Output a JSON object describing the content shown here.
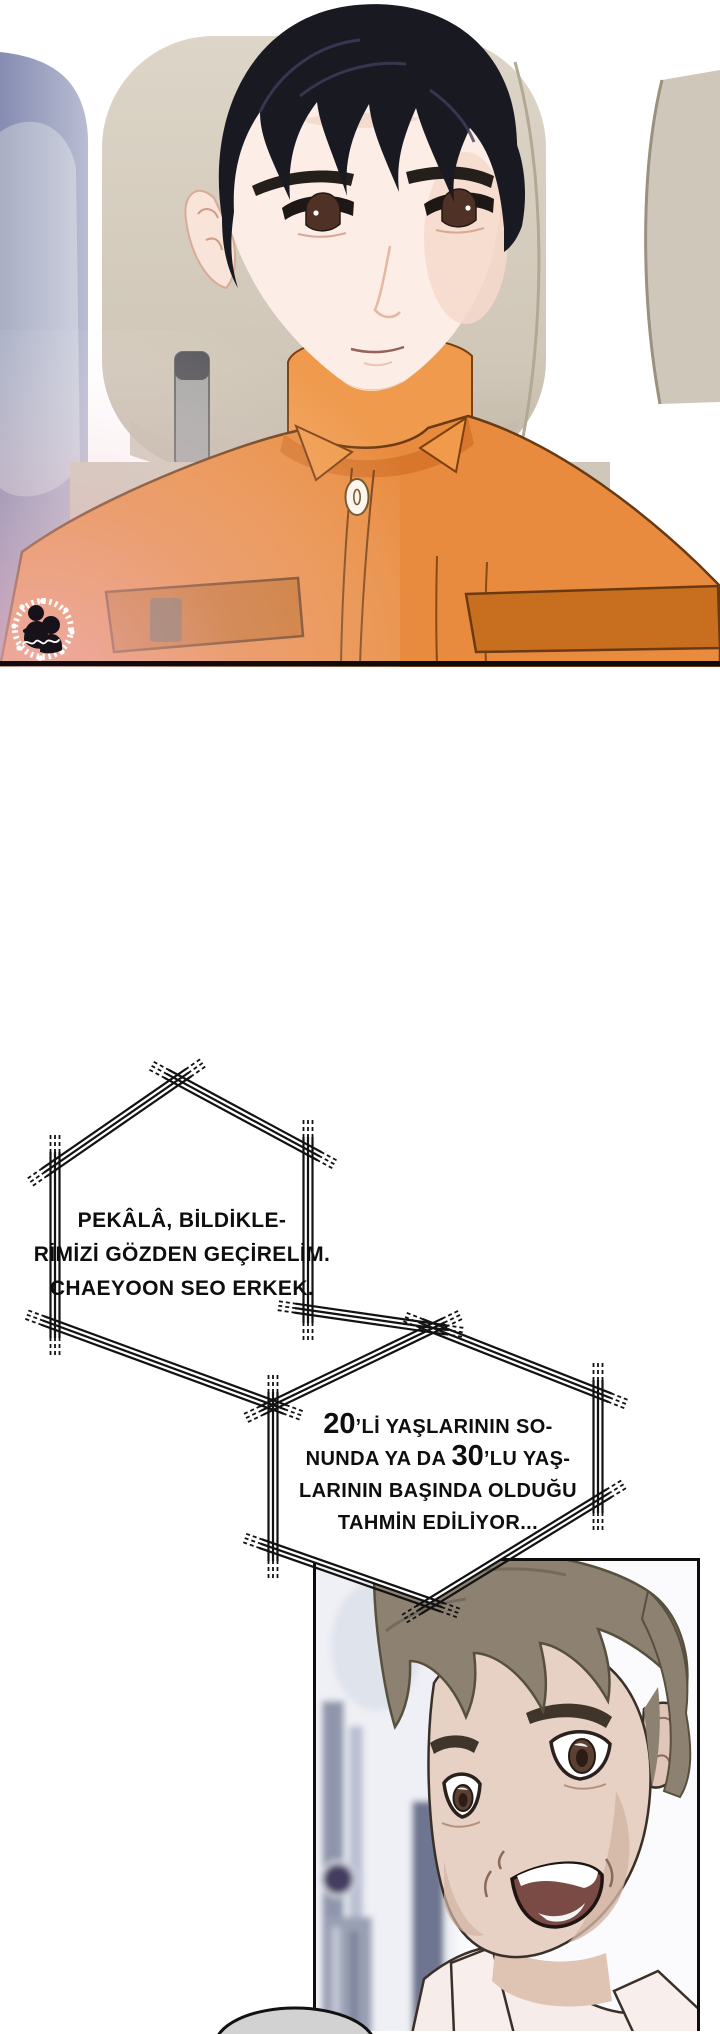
{
  "page": {
    "type": "webtoon-comic-page",
    "background": "#ffffff"
  },
  "bubbles": {
    "bubble1": {
      "lines": [
        "PEKÂLÂ, BİLDİKLE-",
        "RİMİZİ GÖZDEN GEÇİRELİM.",
        "CHAEYOON SEO ERKEK."
      ]
    },
    "bubble2": {
      "line1_num": "20",
      "line1_rest": "’Lİ YAŞLARININ SO-",
      "line2_pre": "NUNDA YA DA ",
      "line2_num": "30",
      "line2_rest": "’LU YAŞ-",
      "line3": "LARININ BAŞINDA OLDUĞU",
      "line4": "TAHMİN EDİLİYOR..."
    }
  },
  "geometry": {
    "fills": [
      [
        [
          178,
          1080
        ],
        [
          308,
          1150
        ],
        [
          308,
          1310
        ],
        [
          433,
          1328
        ],
        [
          273,
          1405
        ],
        [
          55,
          1325
        ],
        [
          55,
          1165
        ]
      ],
      [
        [
          433,
          1328
        ],
        [
          598,
          1393
        ],
        [
          598,
          1500
        ],
        [
          430,
          1603
        ],
        [
          273,
          1548
        ],
        [
          273,
          1405
        ]
      ]
    ],
    "edges": [
      [
        178,
        1080,
        55,
        1165
      ],
      [
        55,
        1165,
        55,
        1325
      ],
      [
        55,
        1325,
        273,
        1405
      ],
      [
        178,
        1080,
        308,
        1150
      ],
      [
        308,
        1150,
        308,
        1310
      ],
      [
        308,
        1310,
        433,
        1328
      ],
      [
        433,
        1328,
        273,
        1405
      ],
      [
        273,
        1405,
        273,
        1548
      ],
      [
        273,
        1548,
        430,
        1603
      ],
      [
        430,
        1603,
        598,
        1500
      ],
      [
        598,
        1500,
        598,
        1393
      ],
      [
        598,
        1393,
        433,
        1328
      ]
    ]
  },
  "colors": {
    "line": "#121212",
    "shirt_orange": "#e98b3e",
    "shirt_orange_dark": "#c76f1f",
    "headrest_beige": "#d6cec0",
    "left_wall_blue": "#8d93b6",
    "hair_black": "#191922",
    "hair_brown_gray": "#8d8272",
    "skin_pale": "#fceee7",
    "skin_tan": "#e7d1c4",
    "mouth_interior": "#7a4a44",
    "gray_bubble": "#d2d2d2"
  },
  "watermark": {
    "icon": "couple-silhouette-lace-wreath-watermark"
  }
}
